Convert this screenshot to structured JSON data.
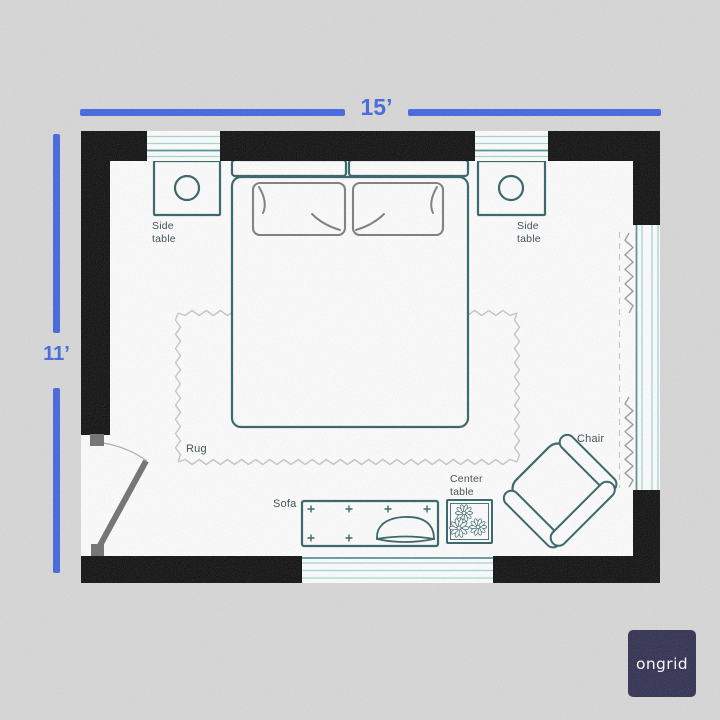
{
  "canvas": {
    "width": 720,
    "height": 720
  },
  "colors": {
    "accent_blue": "#3F63E0",
    "wall_black": "#0B0B0B",
    "furniture_teal": "#2F5F63",
    "window_teal_light": "#A2D6D2",
    "window_teal_dark": "#4E8E8E",
    "detail_gray": "#7B7B7B",
    "door_gray": "#6E6E6E",
    "rug_gray": "#C6C6C6",
    "label_dark": "#36474A",
    "background_gray": "#D8D8D8",
    "floor_white": "#FFFFFF",
    "logo_bg": "#2D2B4E",
    "logo_text": "#FFFFFF"
  },
  "dimensions": {
    "horizontal": "15’",
    "vertical": "11’"
  },
  "labels": {
    "side_table_left": "Side\ntable",
    "side_table_right": "Side\ntable",
    "rug": "Rug",
    "sofa": "Sofa",
    "center_table": "Center\ntable",
    "chair": "Chair"
  },
  "logo": {
    "text": "ongrid"
  }
}
